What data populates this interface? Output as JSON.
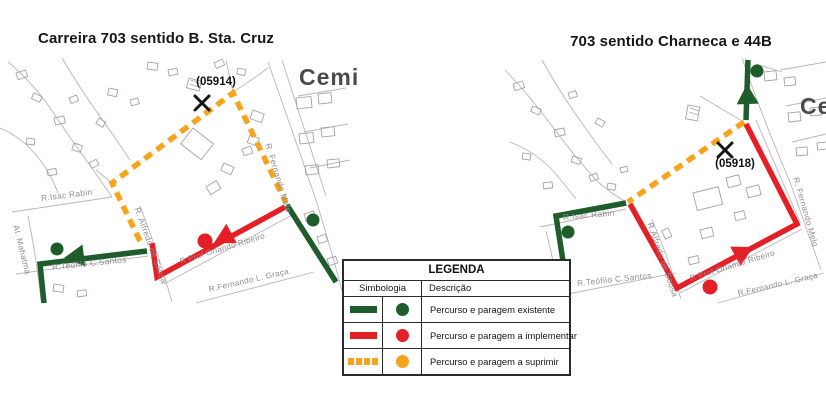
{
  "left_panel": {
    "title": "Carreira 703 sentido B. Sta. Cruz",
    "stop_code": "(05914)",
    "area_label": "Cemi",
    "streets": {
      "isac_rabin": "R.Isac Rabin",
      "mahatma": "Al. Mahatma",
      "teofilo": "R.Teófilo C.Santos",
      "alfredo": "R. Alfredo de Sousa",
      "orlando": "R Prof Orlando Ribeiro",
      "graca": "R.Fernando  L. Graça",
      "fernando_melo": "R. Fernando Melo"
    }
  },
  "right_panel": {
    "title": "703 sentido Charneca e 44B",
    "stop_code": "(05918)",
    "area_label": "Ce",
    "streets": {
      "isac_rabin": "R.Isac Rabin",
      "teofilo": "R.Teófilo C.Santos",
      "alfredo": "R.Alfredo de Sousa",
      "orlando": "R Prof Orlando Ribeiro",
      "graca": "R.Fernando  L. Graça",
      "fernando_melo": "R. Fernando Melo"
    }
  },
  "legend": {
    "title": "LEGENDA",
    "columns": {
      "symbol": "Simbologia",
      "description": "Descrição"
    },
    "rows": [
      {
        "description": "Percurso e paragem existente"
      },
      {
        "description": "Percurso e paragem a implementar"
      },
      {
        "description": "Percurso e paragem a suprimir"
      }
    ]
  },
  "colors": {
    "existing": "#1f5c2b",
    "implement": "#e41f26",
    "suppress": "#f5a41c"
  }
}
